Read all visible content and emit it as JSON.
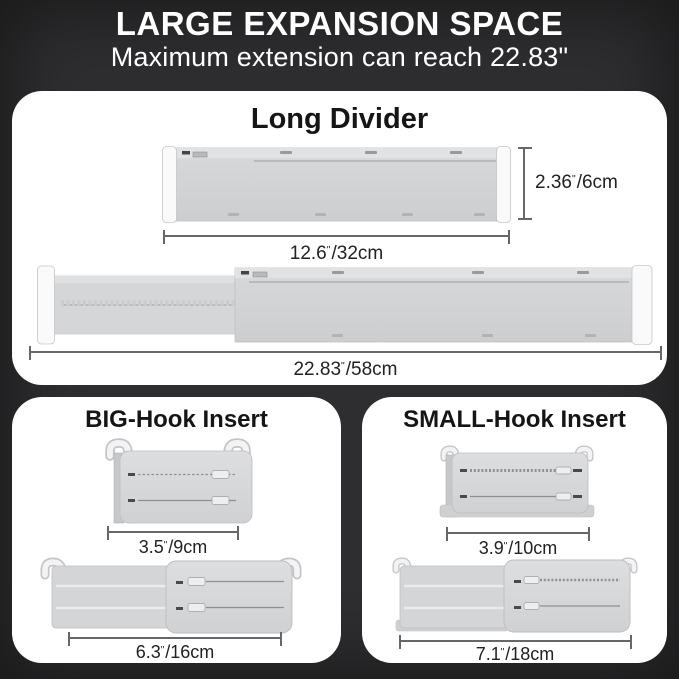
{
  "banner": {
    "title": "LARGE EXPANSION SPACE",
    "subtitle": "Maximum extension can reach 22.83\""
  },
  "inch_mark": "\"",
  "long_divider": {
    "title": "Long Divider",
    "height": {
      "num": "2.36",
      "suffix": "/6cm"
    },
    "compact_width": {
      "num": "12.6",
      "suffix": "/32cm"
    },
    "extended_width": {
      "num": "22.83",
      "suffix": "/58cm"
    }
  },
  "big_hook": {
    "title": "BIG-Hook Insert",
    "compact_width": {
      "num": "3.5",
      "suffix": "/9cm"
    },
    "extended_width": {
      "num": "6.3",
      "suffix": "/16cm"
    }
  },
  "small_hook": {
    "title": "SMALL-Hook Insert",
    "compact_width": {
      "num": "3.9",
      "suffix": "/10cm"
    },
    "extended_width": {
      "num": "7.1",
      "suffix": "/18cm"
    }
  },
  "colors": {
    "background": "#2e2e30",
    "panel": "#ffffff",
    "product_body": "#d4d5d7",
    "product_cap": "#fafafa",
    "dim_line": "#676767",
    "label_text": "#222222",
    "banner_text": "#ffffff"
  }
}
